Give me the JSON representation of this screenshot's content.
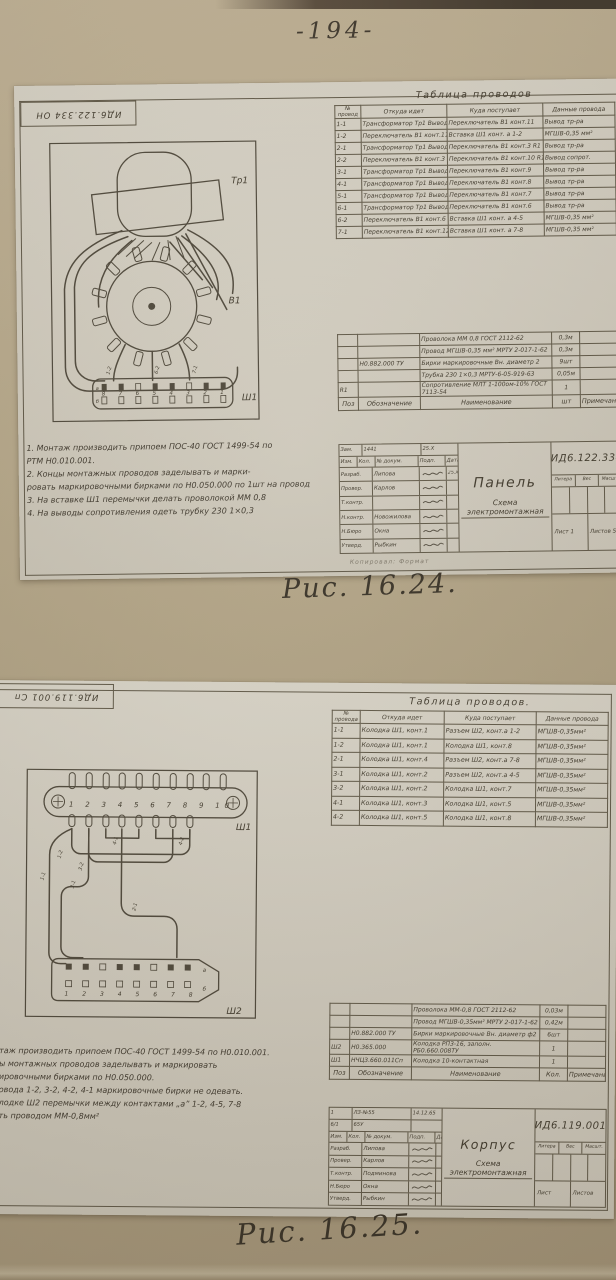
{
  "page": {
    "number": "-194-",
    "fig1_caption": "Рис. 16.24.",
    "fig2_caption": "Рис. 16.25."
  },
  "sheet1": {
    "stamp": "ИД6.122.334 ОН",
    "wire_table": {
      "title": "Таблица проводов",
      "col_n1": "№",
      "col_n2": "провод",
      "col_from": "Откуда идет",
      "col_to": "Куда поступает",
      "col_data": "Данные провода",
      "rows": [
        {
          "n": "1-1",
          "from": "Трансформатор Тр1 Вывод 1",
          "to": "Переключатель В1 конт.11",
          "data": "Вывод тр-ра"
        },
        {
          "n": "1-2",
          "from": "Переключатель В1 конт.11",
          "to": "Вставка Ш1 конт. а 1-2",
          "data": "МГШВ-0,35 мм²"
        },
        {
          "n": "2-1",
          "from": "Трансформатор Тр1 Вывод 2",
          "to": "Переключатель В1 конт.3 R1",
          "data": "Вывод тр-ра"
        },
        {
          "n": "2-2",
          "from": "Переключатель В1 конт.3 R1",
          "to": "Переключатель В1 конт.10 R1",
          "data": "Вывод сопрот."
        },
        {
          "n": "3-1",
          "from": "Трансформатор Тр1 Вывод 3",
          "to": "Переключатель В1 конт.9",
          "data": "Вывод тр-ра"
        },
        {
          "n": "4-1",
          "from": "Трансформатор Тр1 Вывод 4",
          "to": "Переключатель В1 конт.8",
          "data": "Вывод тр-ра"
        },
        {
          "n": "5-1",
          "from": "Трансформатор Тр1 Вывод 5",
          "to": "Переключатель В1 конт.7",
          "data": "Вывод тр-ра"
        },
        {
          "n": "6-1",
          "from": "Трансформатор Тр1 Вывод 6",
          "to": "Переключатель В1 конт.6",
          "data": "Вывод тр-ра"
        },
        {
          "n": "6-2",
          "from": "Переключатель В1 конт.6",
          "to": "Вставка Ш1 конт. а 4-5",
          "data": "МГШВ-0,35 мм²"
        },
        {
          "n": "7-1",
          "from": "Переключатель В1 конт.12",
          "to": "Вставка Ш1 конт. а 7-8",
          "data": "МГШВ-0,35 мм²"
        }
      ]
    },
    "materials": {
      "rows": [
        {
          "pos": "",
          "ref": "",
          "name": "Проволока ММ 0,8 ГОСТ 2112-62",
          "qty": "0,3м",
          "note": ""
        },
        {
          "pos": "",
          "ref": "",
          "name": "Провод МГШВ-0,35 мм² МРТУ 2-017-1-62",
          "qty": "0,3м",
          "note": ""
        },
        {
          "pos": "",
          "ref": "Н0.882.000 ТУ",
          "name": "Бирки маркировочные Вн. диаметр 2",
          "qty": "9шт",
          "note": ""
        },
        {
          "pos": "",
          "ref": "",
          "name": "Трубка 230 1×0,3 МРТУ-6-05-919-63",
          "qty": "0,05м",
          "note": ""
        },
        {
          "pos": "R1",
          "ref": "",
          "name": "Сопротивление МЛТ 1-100ом-10% ГОСТ 7113-54",
          "qty": "1",
          "note": ""
        }
      ],
      "footer": {
        "pos": "Поз",
        "ref": "Обозначение",
        "name": "Наименование",
        "qty": "шт",
        "note": "Примечание"
      }
    },
    "title_block": {
      "doc_number": "ИД6.122.334",
      "product": "Панель",
      "doc_type": "Схема электромонтажная",
      "change_row": {
        "c1": "Зам.",
        "c2": "1441",
        "c3": "25.X"
      },
      "header_row": {
        "c1": "Изм.",
        "c2": "Кол.",
        "c3": "№ докум.",
        "c4": "Подп.",
        "c5": "Дата"
      },
      "sign_rows": [
        {
          "role": "Разраб.",
          "name": "Липова",
          "date": "25.X"
        },
        {
          "role": "Провер.",
          "name": "Карлов",
          "date": ""
        },
        {
          "role": "Т.контр.",
          "name": "",
          "date": ""
        },
        {
          "role": "Н.контр.",
          "name": "Новожилова",
          "date": ""
        },
        {
          "role": "Н.Бюро",
          "name": "Окна",
          "date": ""
        },
        {
          "role": "Утверд.",
          "name": "Рыбкин",
          "date": ""
        }
      ],
      "litera_label": "Литера",
      "weight_label": "Вес",
      "scale_label": "Масшт.",
      "sheet_label": "Лист 1",
      "sheets_label": "Листов 5"
    },
    "notes": [
      "1. Монтаж производить припоем ПОС-40 ГОСТ 1499-54 по",
      "РТМ Н0.010.001.",
      "2. Концы монтажных проводов заделывать и марки-",
      "ровать маркировочными бирками по Н0.050.000 по 1шт на провод",
      "3. На вставке Ш1 перемычки делать проволокой ММ 0,8",
      "4. На выводы сопротивления одеть трубку 230  1×0,3"
    ],
    "copy_line": "Копировал:                    Формат",
    "diagram": {
      "transformer_label": "Тр1",
      "switch_label": "В1",
      "connector_label": "Ш1",
      "pin_numbers": "8 7 6 5 4 3 2 1",
      "row_a": "а",
      "row_b": "б",
      "wire_labels": [
        "1-2",
        "6-2",
        "7-1"
      ]
    }
  },
  "sheet2": {
    "stamp": "ИД6.119.001 Сп",
    "wire_table": {
      "title": "Таблица проводов.",
      "col_n1": "№",
      "col_n2": "провода",
      "col_from": "Откуда идет",
      "col_to": "Куда поступает",
      "col_data": "Данные провода",
      "rows": [
        {
          "n": "1-1",
          "from": "Колодка Ш1, конт.1",
          "to": "Разъем Ш2, конт.а 1-2",
          "data": "МГШВ-0,35мм²"
        },
        {
          "n": "1-2",
          "from": "Колодка Ш1, конт.1",
          "to": "Колодка Ш1, конт.8",
          "data": "МГШВ-0,35мм²"
        },
        {
          "n": "2-1",
          "from": "Колодка Ш1, конт.4",
          "to": "Разъем Ш2, конт.а 7-8",
          "data": "МГШВ-0,35мм²"
        },
        {
          "n": "3-1",
          "from": "Колодка Ш1, конт.2",
          "to": "Разъем Ш2, конт.а 4-5",
          "data": "МГШВ-0,35мм²"
        },
        {
          "n": "3-2",
          "from": "Колодка Ш1, конт.2",
          "to": "Колодка Ш1, конт.7",
          "data": "МГШВ-0,35мм²"
        },
        {
          "n": "4-1",
          "from": "Колодка Ш1, конт.3",
          "to": "Колодка Ш1, конт.5",
          "data": "МГШВ-0,35мм²"
        },
        {
          "n": "4-2",
          "from": "Колодка Ш1, конт.5",
          "to": "Колодка Ш1, конт.8",
          "data": "МГШВ-0,35мм²"
        }
      ]
    },
    "materials": {
      "rows": [
        {
          "pos": "",
          "ref": "",
          "name": "Проволока ММ-0,8 ГОСТ 2112-62",
          "qty": "0,03м",
          "note": ""
        },
        {
          "pos": "",
          "ref": "",
          "name": "Провод МГШВ-0,35мм² МРТУ 2-017-1-62",
          "qty": "0,42м",
          "note": ""
        },
        {
          "pos": "",
          "ref": "Н0.882.000 ТУ",
          "name": "Бирки маркировочные Вн. диаметр ф2",
          "qty": "6шт",
          "note": ""
        },
        {
          "pos": "Ш2",
          "ref": "Н0.365.000",
          "name": "Колодка РП3-16, заполн. РБ0.660.008ТУ",
          "qty": "1",
          "note": ""
        },
        {
          "pos": "Ш1",
          "ref": "НЧЦ3.660.011Сп",
          "name": "Колодка 10-контактная",
          "qty": "1",
          "note": ""
        }
      ],
      "footer": {
        "pos": "Поз",
        "ref": "Обозначение",
        "name": "Наименование",
        "qty": "Кол.",
        "note": "Примечание"
      }
    },
    "title_block": {
      "doc_number": "ИД6.119.001",
      "product": "Корпус",
      "doc_type": "Схема электромонтажная",
      "change_row": {
        "c1": "1",
        "c2": "ЛЗ-№55",
        "c3": "14.12.65"
      },
      "change_row2": {
        "c1": "6/1",
        "c2": "65У",
        "c3": ""
      },
      "header_row": {
        "c1": "Изм.",
        "c2": "Кол.",
        "c3": "№ докум.",
        "c4": "Подп.",
        "c5": "Дата"
      },
      "sign_rows": [
        {
          "role": "Разраб.",
          "name": "Липова",
          "date": ""
        },
        {
          "role": "Провер.",
          "name": "Карлов",
          "date": ""
        },
        {
          "role": "Т.контр.",
          "name": "Подминова",
          "date": ""
        },
        {
          "role": "Н.Бюро",
          "name": "Окна",
          "date": ""
        },
        {
          "role": "Утверд.",
          "name": "Рыбкин",
          "date": ""
        }
      ],
      "litera_label": "Литера",
      "weight_label": "Вес",
      "scale_label": "Масшт.",
      "sheet_label": "Лист",
      "sheets_label": "Листов"
    },
    "notes": [
      "таж производить припоем ПОС-40 ГОСТ 1499-54 по Н0.010.001.",
      "ы монтажных проводов заделывать и маркировать",
      "ировочными бирками по Н0.050.000.",
      "овода 1-2, 3-2, 4-2, 4-1 маркировочные бирки не одевать.",
      "лодке Ш2 перемычки между контактами „а” 1-2, 4-5, 7-8",
      "ть проводом ММ-0,8мм²"
    ],
    "diagram": {
      "block_label": "Ш1",
      "connector_label": "Ш2",
      "pin_numbers_top": "1 2 3 4 5 6 7 8 9 10",
      "pin_numbers_bottom": "1 2 3 4 5 6 7 8",
      "row_letter": "а",
      "row_letter2": "б",
      "wire_labels": [
        "1-1",
        "1-2",
        "3-1",
        "3-2",
        "4-1",
        "4-2",
        "2-1"
      ]
    }
  }
}
